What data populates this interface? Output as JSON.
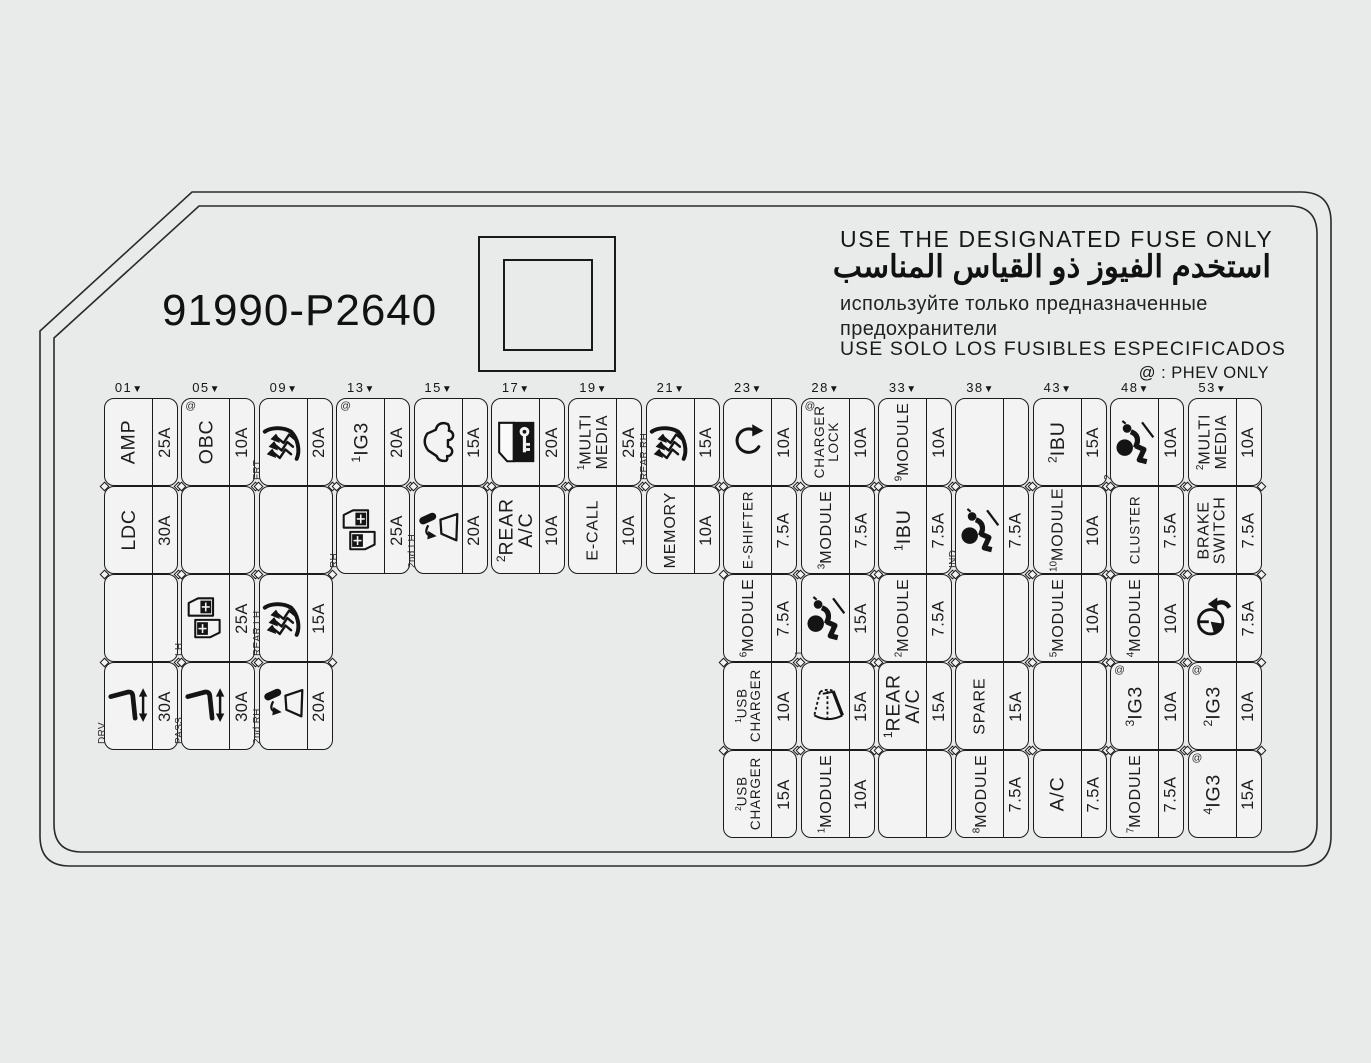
{
  "panel": {
    "part_number": "91990-P2640",
    "warning_en": "USE THE DESIGNATED FUSE ONLY",
    "warning_ar": "استخدم الفيوز ذو القياس المناسب",
    "warning_ru": "используйте только предназначенные\nпредохранители",
    "warning_es": "USE SOLO LOS FUSIBLES ESPECIFICADOS",
    "phev_note": "@ : PHEV ONLY",
    "phev_symbol": "@"
  },
  "colors": {
    "line": "#1b1b1b",
    "background": "#e9ebea",
    "cell_fill": "#f2f3f2"
  },
  "grid": {
    "column_marker": "▼",
    "columns": [
      "01",
      "05",
      "09",
      "13",
      "15",
      "17",
      "19",
      "21",
      "23",
      "28",
      "33",
      "38",
      "43",
      "48",
      "53"
    ],
    "cells": [
      {
        "col": 0,
        "row": 0,
        "label": "AMP",
        "amp": "25A"
      },
      {
        "col": 0,
        "row": 1,
        "label": "LDC",
        "amp": "30A"
      },
      {
        "col": 0,
        "row": 2,
        "empty": true
      },
      {
        "col": 0,
        "row": 3,
        "icon": "power-seat",
        "sublabel": "DRV",
        "amp": "30A"
      },
      {
        "col": 1,
        "row": 0,
        "label": "OBC",
        "phev": true,
        "amp": "10A"
      },
      {
        "col": 1,
        "row": 1,
        "empty": true
      },
      {
        "col": 1,
        "row": 2,
        "icon": "power-window",
        "sublabel": "LH",
        "amp": "25A"
      },
      {
        "col": 1,
        "row": 3,
        "icon": "power-seat",
        "sublabel": "PASS",
        "amp": "30A"
      },
      {
        "col": 2,
        "row": 0,
        "icon": "seat-heater",
        "sublabel": "FRT",
        "amp": "20A"
      },
      {
        "col": 2,
        "row": 1,
        "empty": true
      },
      {
        "col": 2,
        "row": 2,
        "icon": "seat-heater",
        "sublabel": "REAR LH",
        "amp": "15A"
      },
      {
        "col": 2,
        "row": 3,
        "icon": "vent-window",
        "sublabel": "2nd RH",
        "amp": "20A"
      },
      {
        "col": 3,
        "row": 0,
        "label": "IG3",
        "sup": "1",
        "phev": true,
        "amp": "20A"
      },
      {
        "col": 3,
        "row": 1,
        "icon": "power-window",
        "sublabel": "RH",
        "amp": "25A"
      },
      {
        "col": 4,
        "row": 0,
        "icon": "car",
        "amp": "15A"
      },
      {
        "col": 4,
        "row": 1,
        "icon": "vent-window",
        "sublabel": "2nd LH",
        "amp": "20A"
      },
      {
        "col": 5,
        "row": 0,
        "icon": "door-lock-key",
        "amp": "20A"
      },
      {
        "col": 5,
        "row": 1,
        "label": "REAR\nA/C",
        "sup": "2",
        "amp": "10A"
      },
      {
        "col": 6,
        "row": 0,
        "label": "MULTI\nMEDIA",
        "sup": "1",
        "amp": "25A"
      },
      {
        "col": 6,
        "row": 1,
        "label": "E-CALL",
        "amp": "10A"
      },
      {
        "col": 7,
        "row": 0,
        "icon": "seat-heater",
        "sublabel": "REAR RH",
        "amp": "15A"
      },
      {
        "col": 7,
        "row": 1,
        "label": "MEMORY",
        "amp": "10A"
      },
      {
        "col": 8,
        "row": 0,
        "icon": "rotary",
        "amp": "10A"
      },
      {
        "col": 8,
        "row": 1,
        "label": "E-SHIFTER",
        "amp": "7.5A"
      },
      {
        "col": 8,
        "row": 2,
        "label": "MODULE",
        "sup": "6",
        "amp": "7.5A"
      },
      {
        "col": 8,
        "row": 3,
        "label": "USB\nCHARGER",
        "sup": "1",
        "amp": "10A"
      },
      {
        "col": 8,
        "row": 4,
        "label": "USB\nCHARGER",
        "sup": "2",
        "amp": "15A"
      },
      {
        "col": 9,
        "row": 0,
        "label": "CHARGER\nLOCK",
        "phev": true,
        "amp": "10A"
      },
      {
        "col": 9,
        "row": 1,
        "label": "MODULE",
        "sup": "3",
        "amp": "7.5A"
      },
      {
        "col": 9,
        "row": 2,
        "icon": "airbag",
        "sup": "1",
        "amp": "15A"
      },
      {
        "col": 9,
        "row": 3,
        "icon": "wiper",
        "amp": "15A"
      },
      {
        "col": 9,
        "row": 4,
        "label": "MODULE",
        "sup": "1",
        "amp": "10A"
      },
      {
        "col": 10,
        "row": 0,
        "label": "MODULE",
        "sup": "9",
        "amp": "10A"
      },
      {
        "col": 10,
        "row": 1,
        "label": "IBU",
        "sup": "1",
        "amp": "7.5A"
      },
      {
        "col": 10,
        "row": 2,
        "label": "MODULE",
        "sup": "2",
        "amp": "7.5A"
      },
      {
        "col": 10,
        "row": 3,
        "label": "REAR\nA/C",
        "sup": "1",
        "amp": "15A"
      },
      {
        "col": 10,
        "row": 4,
        "empty": true
      },
      {
        "col": 11,
        "row": 0,
        "empty": true
      },
      {
        "col": 11,
        "row": 1,
        "icon": "airbag",
        "sublabel": "IND",
        "amp": "7.5A"
      },
      {
        "col": 11,
        "row": 2,
        "empty": true
      },
      {
        "col": 11,
        "row": 3,
        "label": "SPARE",
        "amp": "15A"
      },
      {
        "col": 11,
        "row": 4,
        "label": "MODULE",
        "sup": "8",
        "amp": "7.5A"
      },
      {
        "col": 12,
        "row": 0,
        "label": "IBU",
        "sup": "2",
        "amp": "15A"
      },
      {
        "col": 12,
        "row": 1,
        "label": "MODULE",
        "sup": "10",
        "amp": "10A"
      },
      {
        "col": 12,
        "row": 2,
        "label": "MODULE",
        "sup": "5",
        "amp": "10A"
      },
      {
        "col": 12,
        "row": 3,
        "empty": true
      },
      {
        "col": 12,
        "row": 4,
        "label": "A/C",
        "amp": "7.5A"
      },
      {
        "col": 13,
        "row": 0,
        "icon": "airbag",
        "sup": "2",
        "amp": "10A"
      },
      {
        "col": 13,
        "row": 1,
        "label": "CLUSTER",
        "amp": "7.5A"
      },
      {
        "col": 13,
        "row": 2,
        "label": "MODULE",
        "sup": "4",
        "amp": "10A"
      },
      {
        "col": 13,
        "row": 3,
        "label": "IG3",
        "sup": "3",
        "phev": true,
        "amp": "10A"
      },
      {
        "col": 13,
        "row": 4,
        "label": "MODULE",
        "sup": "7",
        "amp": "7.5A"
      },
      {
        "col": 14,
        "row": 0,
        "label": "MULTI\nMEDIA",
        "sup": "2",
        "amp": "10A"
      },
      {
        "col": 14,
        "row": 1,
        "label": "BRAKE\nSWITCH",
        "amp": "7.5A"
      },
      {
        "col": 14,
        "row": 2,
        "icon": "steering-heat",
        "amp": "7.5A"
      },
      {
        "col": 14,
        "row": 3,
        "label": "IG3",
        "sup": "2",
        "phev": true,
        "amp": "10A"
      },
      {
        "col": 14,
        "row": 4,
        "label": "IG3",
        "sup": "4",
        "phev": true,
        "amp": "15A"
      }
    ]
  }
}
